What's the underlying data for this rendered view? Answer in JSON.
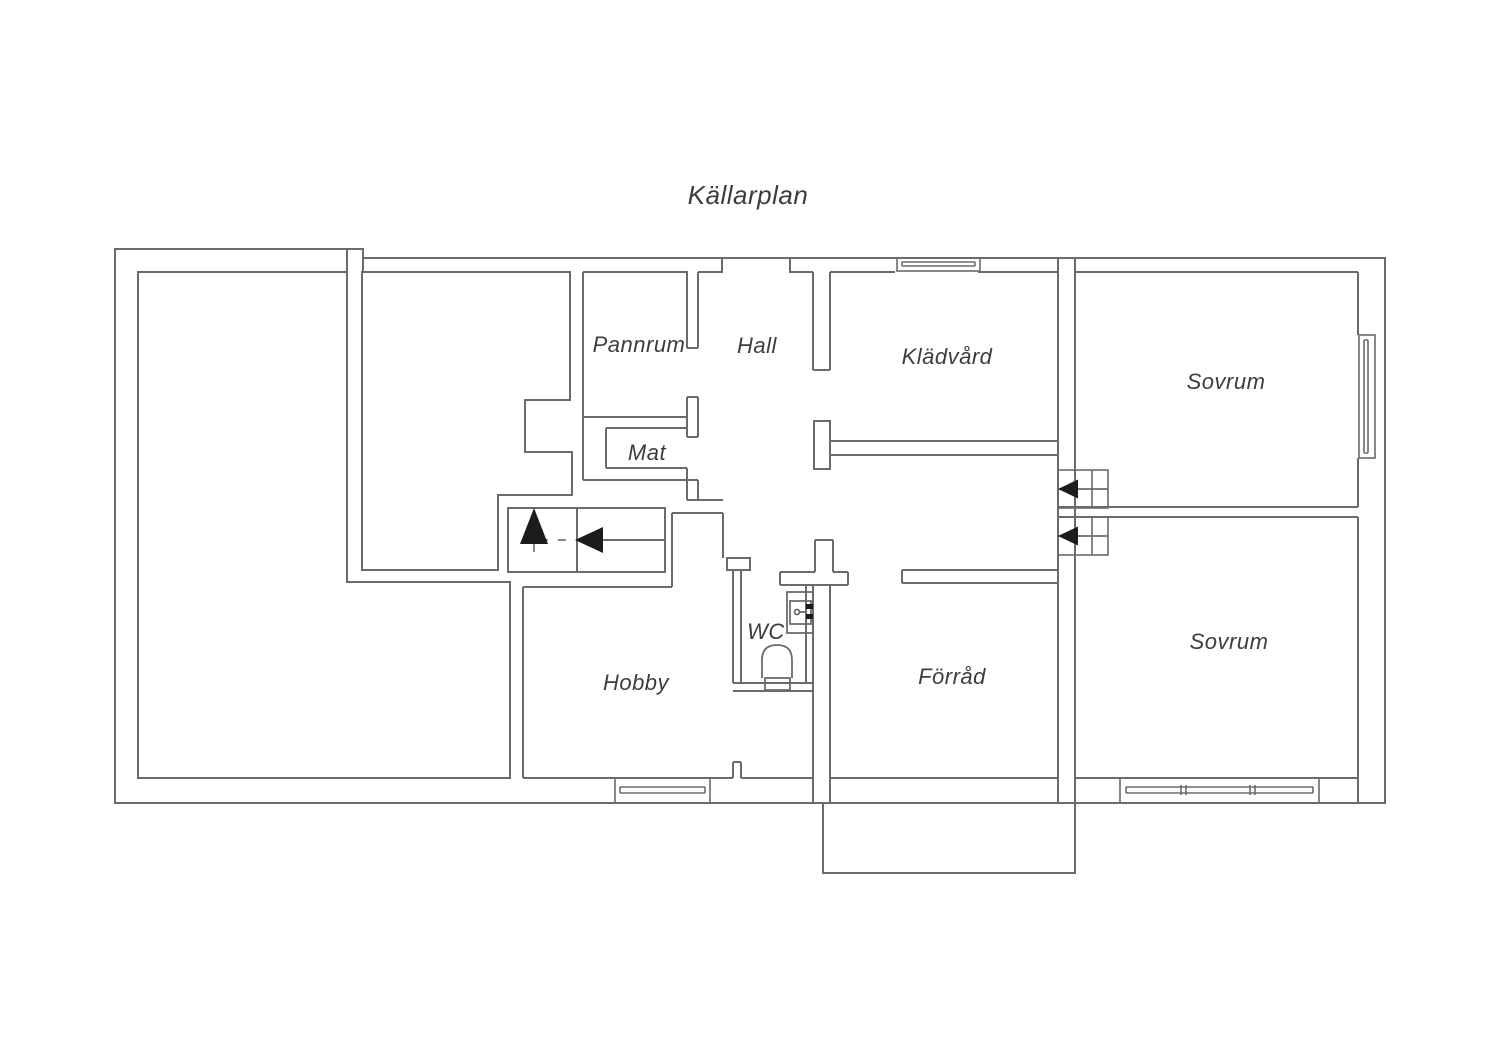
{
  "title": "Källarplan",
  "floorplan": {
    "labels": {
      "pannrum": "Pannrum",
      "hall": "Hall",
      "kladvard": "Klädvård",
      "sovrum_top": "Sovrum",
      "mat": "Mat",
      "hobby": "Hobby",
      "wc": "WC",
      "forrad": "Förråd",
      "sovrum_bottom": "Sovrum"
    },
    "colors": {
      "wall": "#6b6b6b",
      "label": "#3d3d3d",
      "fixture_black": "#1c1c1c",
      "background": "#ffffff"
    }
  }
}
